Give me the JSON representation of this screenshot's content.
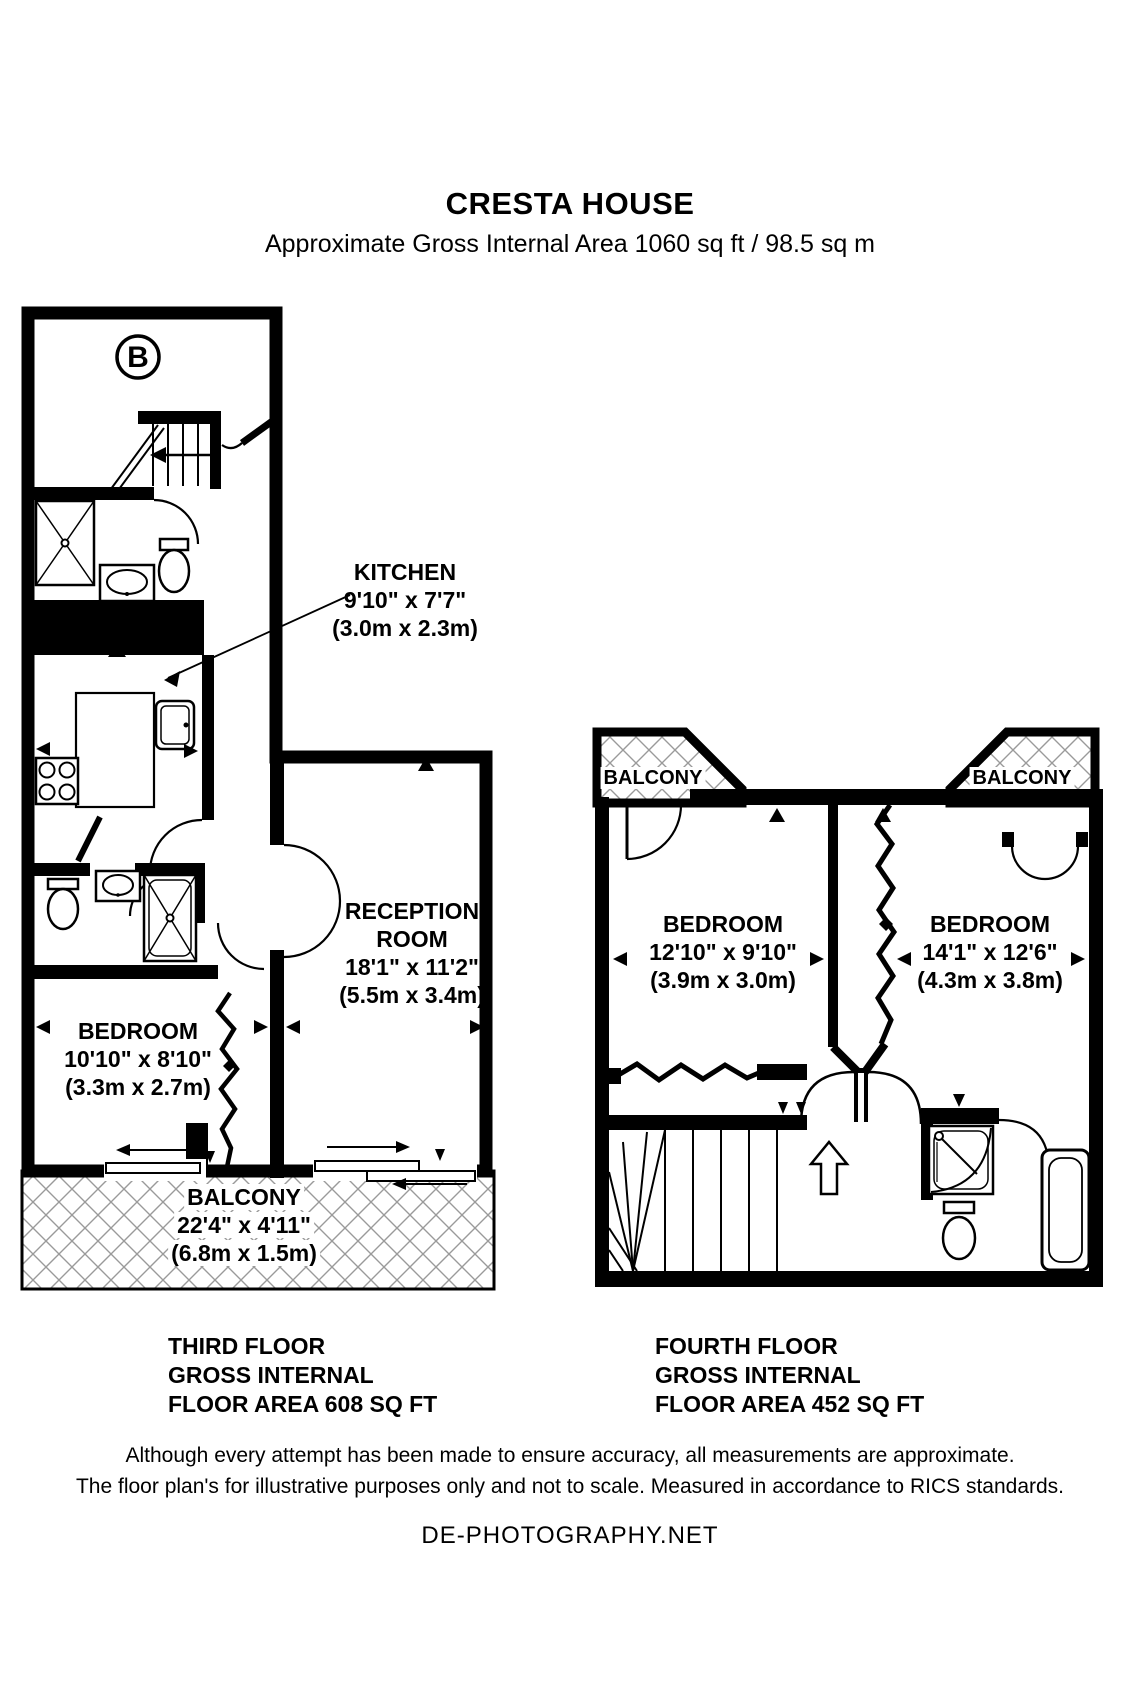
{
  "header": {
    "title": "CRESTA HOUSE",
    "subtitle": "Approximate Gross Internal Area 1060 sq ft / 98.5 sq m"
  },
  "third_floor": {
    "compass_label": "B",
    "rooms": {
      "kitchen": {
        "name": "KITCHEN",
        "imperial": "9'10\" x 7'7\"",
        "metric": "(3.0m x 2.3m)"
      },
      "reception": {
        "name_line1": "RECEPTION",
        "name_line2": "ROOM",
        "imperial": "18'1\" x 11'2\"",
        "metric": "(5.5m x 3.4m)"
      },
      "bedroom": {
        "name": "BEDROOM",
        "imperial": "10'10\" x 8'10\"",
        "metric": "(3.3m x 2.7m)"
      },
      "balcony": {
        "name": "BALCONY",
        "imperial": "22'4\" x 4'11\"",
        "metric": "(6.8m x 1.5m)"
      }
    },
    "footer": {
      "line1": "THIRD FLOOR",
      "line2": "GROSS INTERNAL",
      "line3": "FLOOR AREA 608 SQ FT"
    }
  },
  "fourth_floor": {
    "rooms": {
      "balcony_left": {
        "name": "BALCONY"
      },
      "balcony_right": {
        "name": "BALCONY"
      },
      "bedroom_left": {
        "name": "BEDROOM",
        "imperial": "12'10\" x 9'10\"",
        "metric": "(3.9m x 3.0m)"
      },
      "bedroom_right": {
        "name": "BEDROOM",
        "imperial": "14'1\" x 12'6\"",
        "metric": "(4.3m x 3.8m)"
      }
    },
    "footer": {
      "line1": "FOURTH FLOOR",
      "line2": "GROSS INTERNAL",
      "line3": "FLOOR AREA 452 SQ FT"
    }
  },
  "disclaimer": {
    "line1": "Although every attempt has been made to ensure accuracy, all measurements are approximate.",
    "line2": "The floor plan's for illustrative purposes only and not to scale. Measured in accordance to RICS standards."
  },
  "credit": "DE-PHOTOGRAPHY.NET",
  "colors": {
    "wall": "#000000",
    "background": "#ffffff",
    "hatch": "#9a9a9a"
  }
}
